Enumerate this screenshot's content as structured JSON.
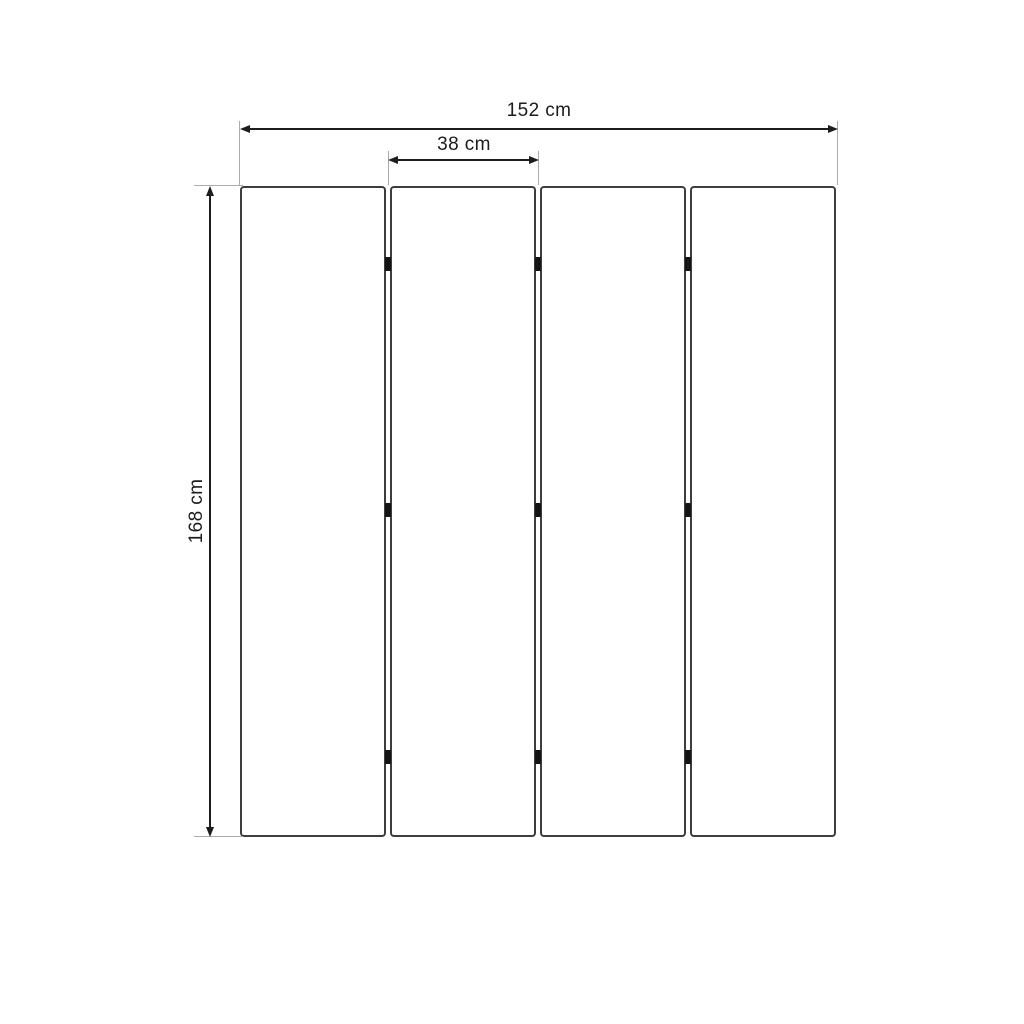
{
  "diagram": {
    "type": "product-dimension-drawing",
    "panel_count": 4,
    "hinge_rows": 3,
    "dimensions": {
      "total_width": {
        "label": "152 cm",
        "value": 152,
        "unit": "cm"
      },
      "panel_width": {
        "label": "38 cm",
        "value": 38,
        "unit": "cm"
      },
      "height": {
        "label": "168 cm",
        "value": 168,
        "unit": "cm"
      }
    },
    "colors": {
      "background": "#ffffff",
      "panel_border": "#3d3d3d",
      "dimension_line": "#1d1d1d",
      "extension_line": "#ababab",
      "hinge": "#151515",
      "text": "#1c1c1c"
    }
  }
}
